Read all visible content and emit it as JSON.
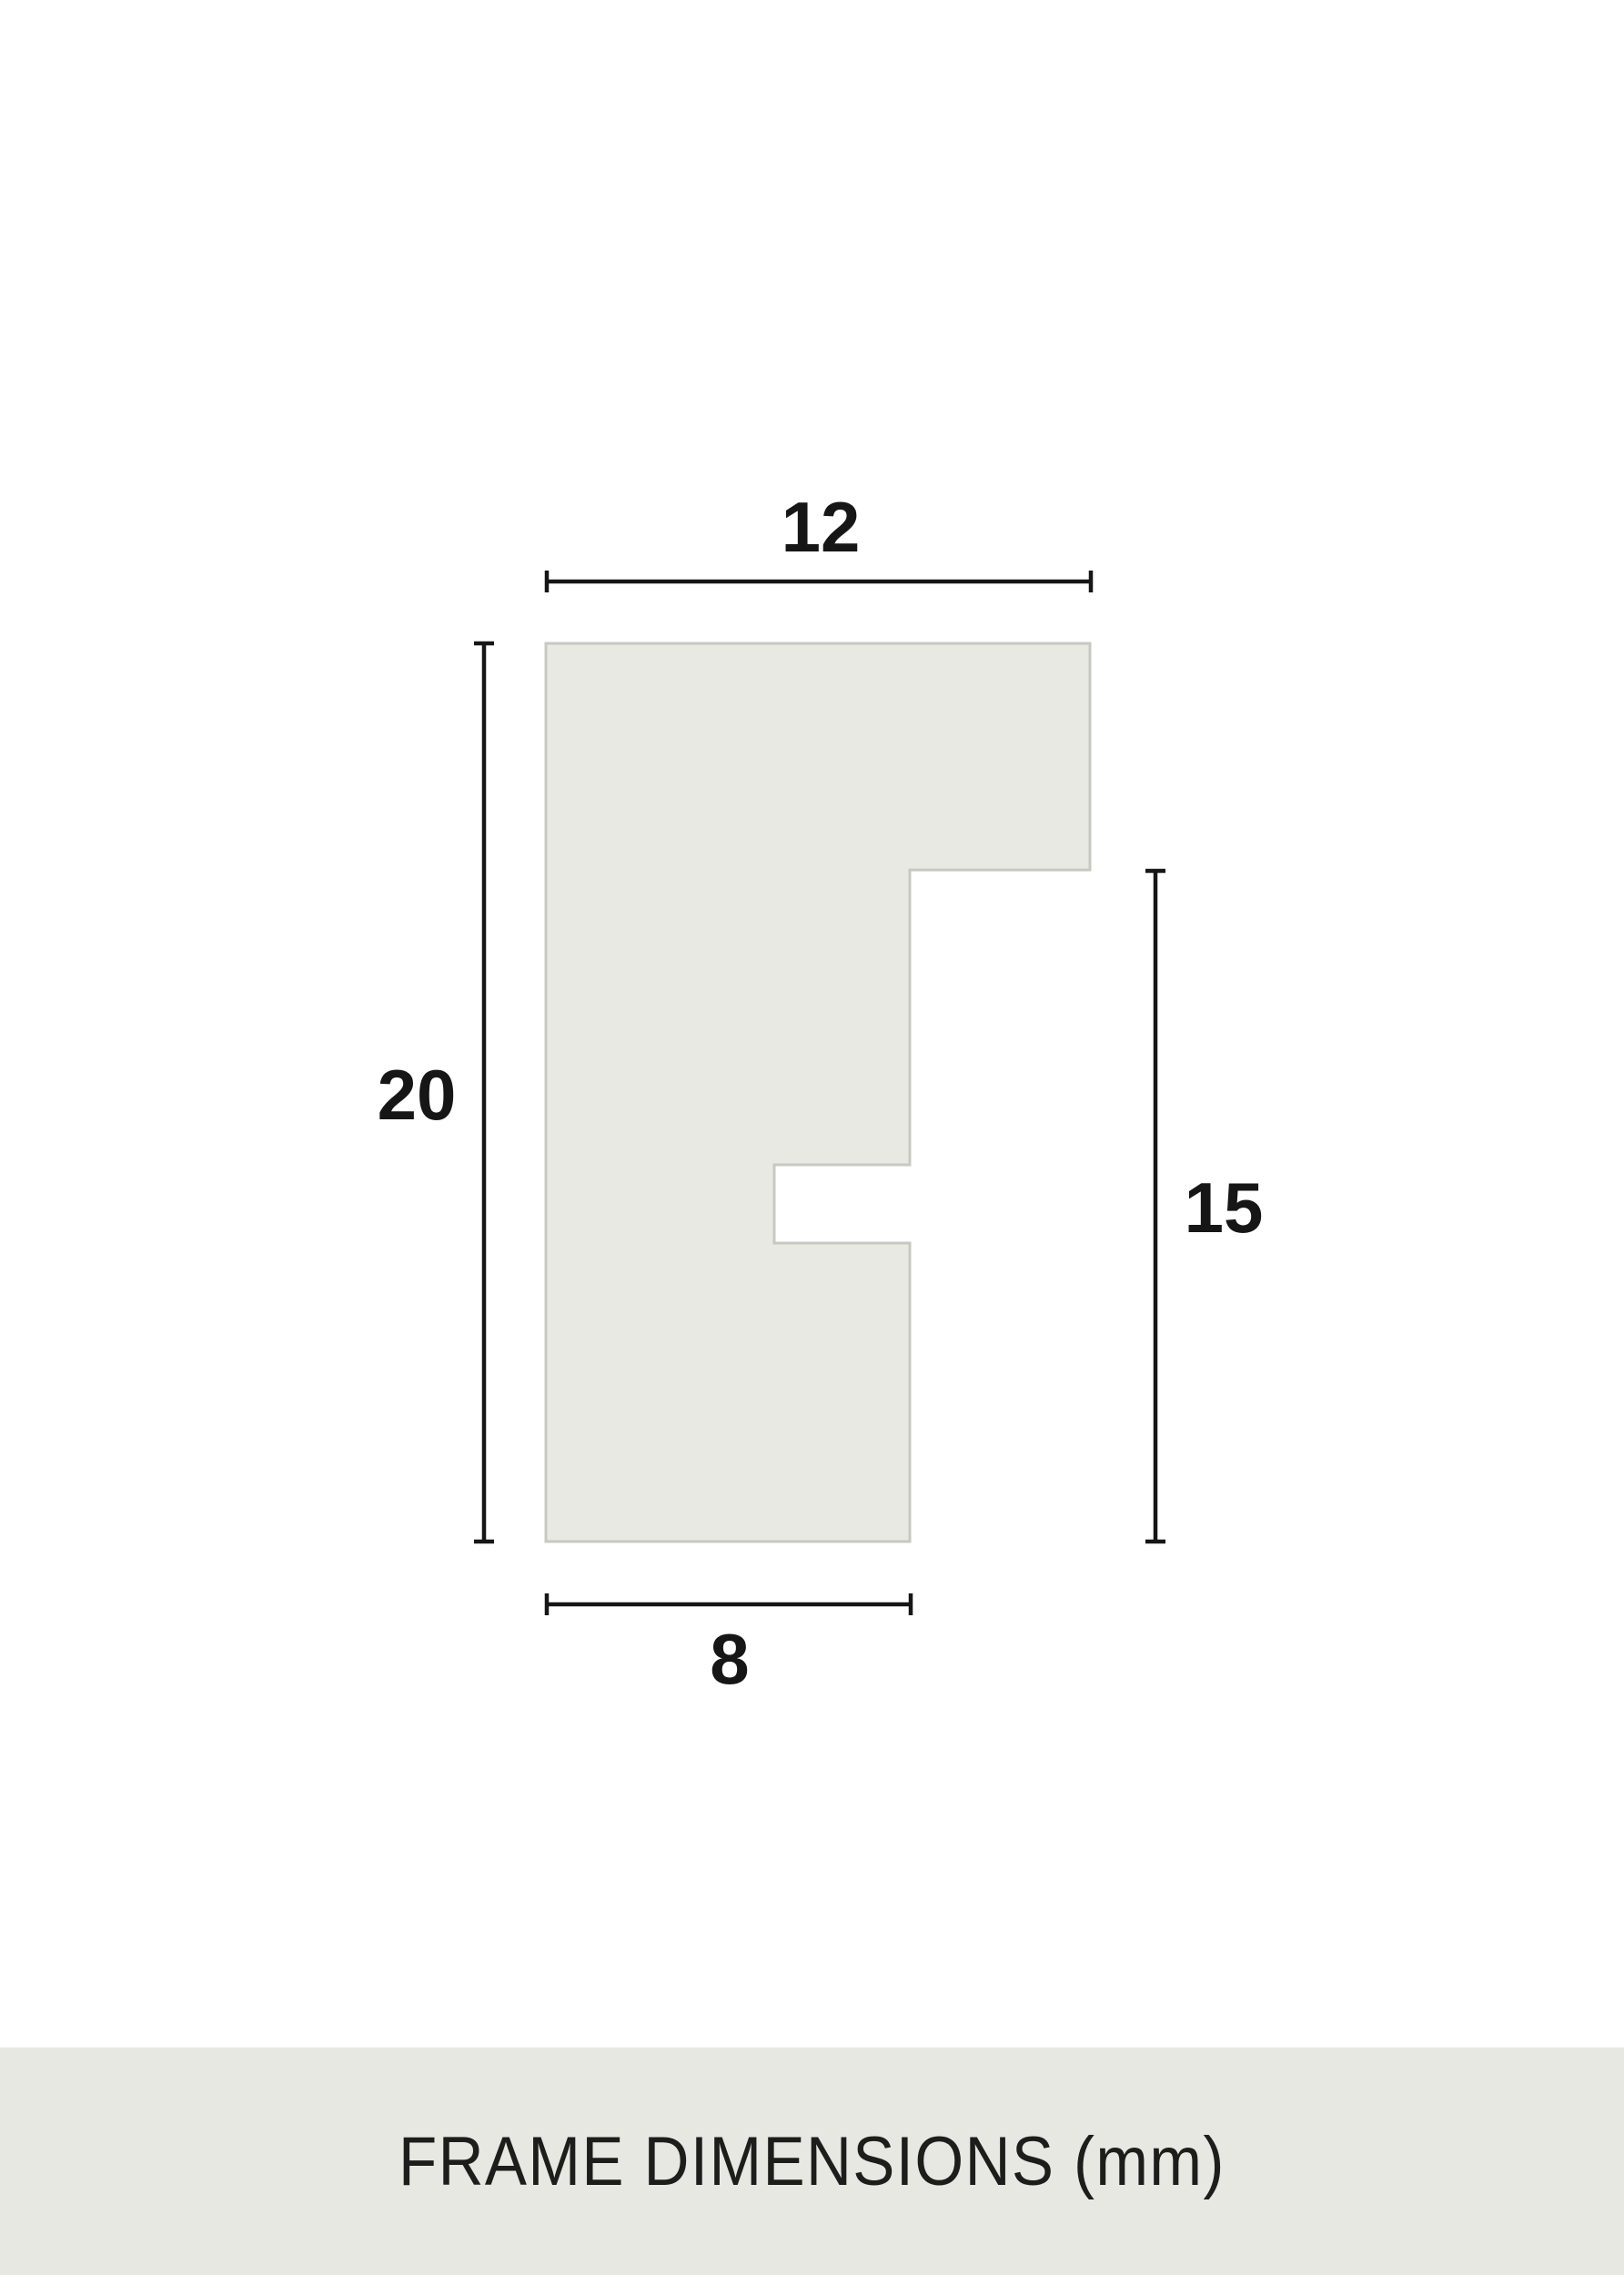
{
  "diagram": {
    "dimensions": {
      "top": "12",
      "left": "20",
      "right": "15",
      "bottom": "8"
    },
    "caption": "FRAME DIMENSIONS (mm)",
    "colors": {
      "page_background": "#ffffff",
      "profile_fill": "#e9e9e3",
      "profile_outline": "#c8c8c3",
      "dimension_line": "#161616",
      "label_text": "#161616",
      "banner_background": "#e8e8e2",
      "banner_text": "#1d1d1b"
    }
  }
}
